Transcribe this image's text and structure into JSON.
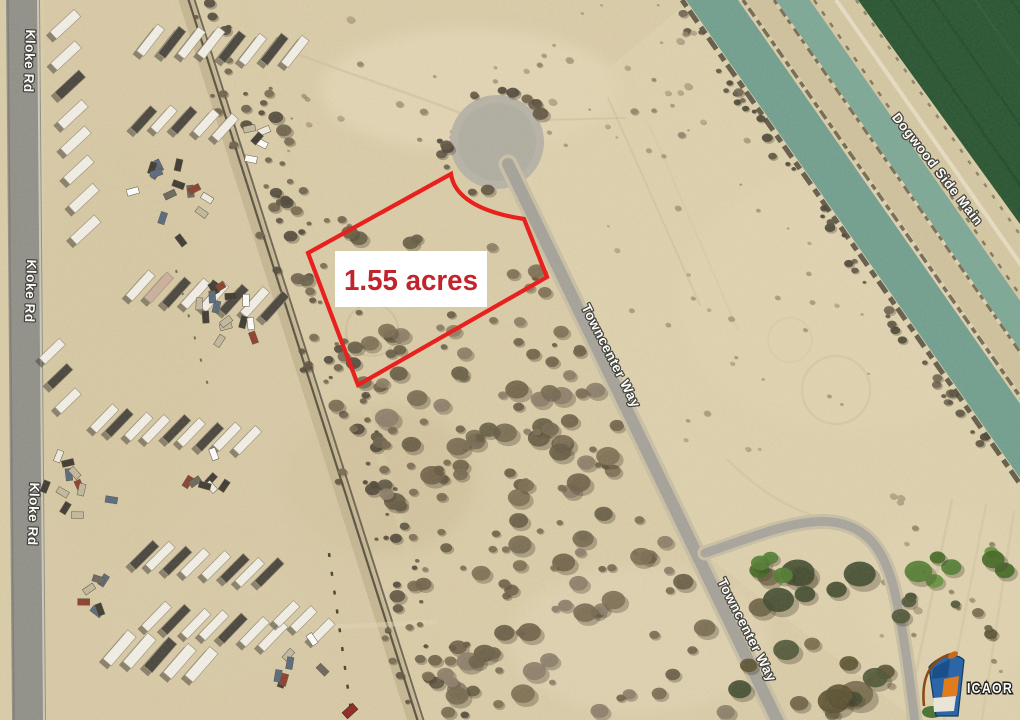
{
  "image": {
    "labels": {
      "kloke_rd": "Kloke Rd",
      "towncenter_way": "Towncenter Way",
      "dogwood_side_main": "Dogwood Side Main"
    },
    "parcel": {
      "area_label": "1.55 acres",
      "outline_color": "#e8211f",
      "label_bg": "#ffffff",
      "label_text_color": "#c2242e"
    },
    "watermark": {
      "text": "ICAOR"
    },
    "palette": {
      "desert": "#dbcda8",
      "asphalt": "#a4a199",
      "kloke_asphalt": "#8f8f88",
      "canal_water": "#6f9e8e",
      "canal_water_light": "#7ba795",
      "farm_field_green": "#24512d",
      "scrub_brush": "#6e6047",
      "road_label_text": "#ffffff"
    }
  }
}
